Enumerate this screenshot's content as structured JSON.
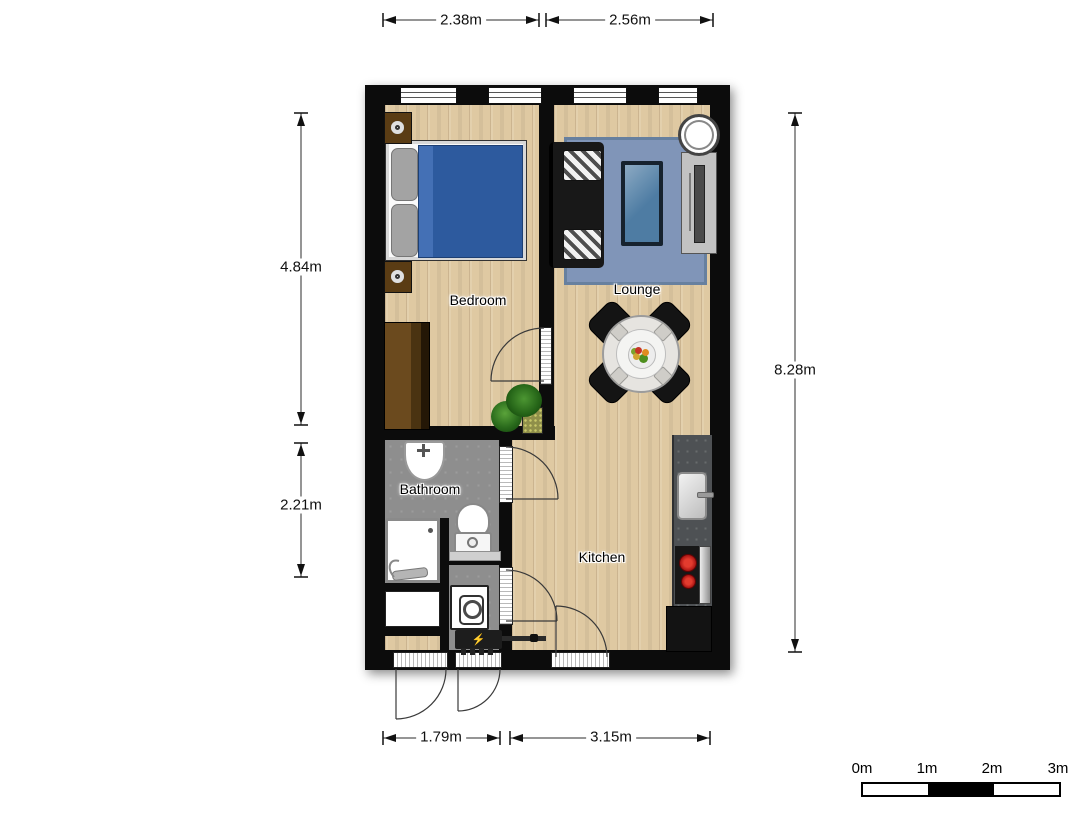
{
  "plan": {
    "rooms": [
      {
        "id": "bedroom",
        "label": "Bedroom"
      },
      {
        "id": "lounge",
        "label": "Lounge"
      },
      {
        "id": "bathroom",
        "label": "Bathroom"
      },
      {
        "id": "kitchen",
        "label": "Kitchen"
      }
    ],
    "dimensions": {
      "top": [
        {
          "label": "2.38m"
        },
        {
          "label": "2.56m"
        }
      ],
      "left": [
        {
          "label": "4.84m"
        },
        {
          "label": "2.21m"
        }
      ],
      "right": [
        {
          "label": "8.28m"
        }
      ],
      "bottom": [
        {
          "label": "1.79m"
        },
        {
          "label": "3.15m"
        }
      ]
    },
    "scale_bar": {
      "labels": [
        "0m",
        "1m",
        "2m",
        "3m"
      ]
    },
    "icons": {
      "lightning": "⚡"
    },
    "furniture": [
      "double-bed",
      "wardrobe",
      "wall-lamp",
      "sofa",
      "rug",
      "coffee-table",
      "tv-unit",
      "ceiling-lamp",
      "dining-table",
      "dining-chair",
      "fruit-bowl",
      "plant",
      "planter",
      "bathroom-sink",
      "toilet",
      "shower",
      "cupboard",
      "washing-machine",
      "electrical-panel",
      "kitchen-counter",
      "kitchen-sink",
      "stove",
      "oven",
      "fridge"
    ],
    "colors": {
      "wall": "#0c0c0c",
      "wood_floor": "#dfc9a2",
      "bathroom_floor": "#8e8e8e",
      "rug": "#8095b8",
      "bed_blanket": "#2d5a9e",
      "sofa": "#181818",
      "coffee_table_glass": "#4e7ca3",
      "counter": "#4e5154",
      "burner_red": "#cc1313",
      "wardrobe_brown": "#5a3c14",
      "plant_green": "#2f7a1f"
    }
  }
}
